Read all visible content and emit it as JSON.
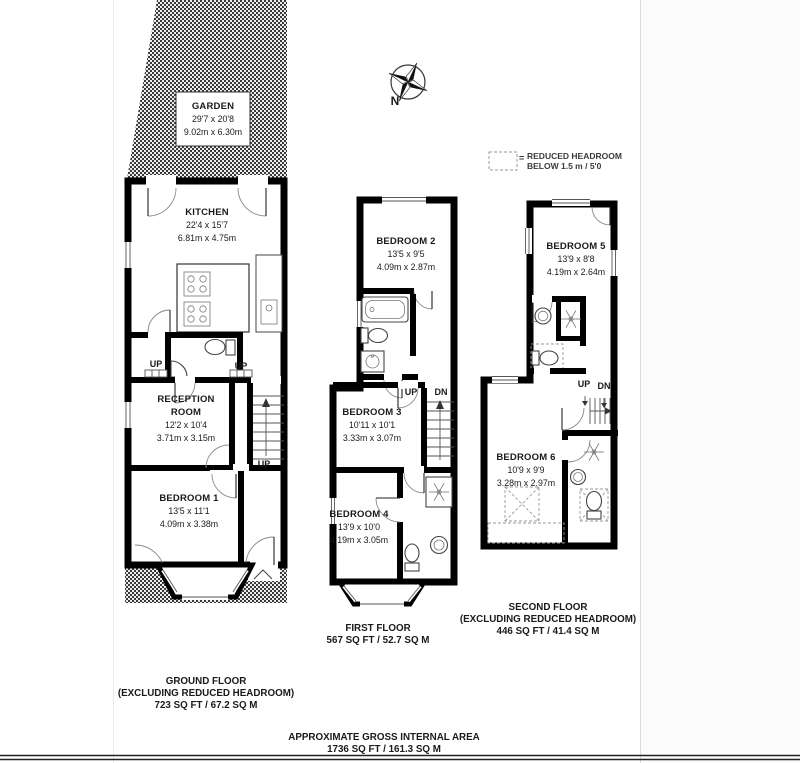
{
  "page": {
    "footer_line1": "APPROXIMATE GROSS INTERNAL AREA",
    "footer_line2": "1736 SQ FT / 161.3 SQ M"
  },
  "compass": {
    "north_label": "N"
  },
  "legend": {
    "equals": "=",
    "line1": "REDUCED HEADROOM",
    "line2": "BELOW 1.5 m / 5'0"
  },
  "stairs": {
    "up": "UP",
    "down": "DN"
  },
  "garden": {
    "name": "GARDEN",
    "dim_imperial": "29'7 x 20'8",
    "dim_metric": "9.02m x 6.30m"
  },
  "ground_floor": {
    "title_line1": "GROUND FLOOR",
    "title_line2": "(EXCLUDING REDUCED HEADROOM)",
    "title_line3": "723 SQ FT / 67.2 SQ M",
    "kitchen": {
      "name": "KITCHEN",
      "dim_imperial": "22'4 x 15'7",
      "dim_metric": "6.81m x 4.75m"
    },
    "reception": {
      "name": "RECEPTION ROOM",
      "dim_imperial": "12'2 x 10'4",
      "dim_metric": "3.71m x 3.15m"
    },
    "bedroom1": {
      "name": "BEDROOM 1",
      "dim_imperial": "13'5 x 11'1",
      "dim_metric": "4.09m x 3.38m"
    }
  },
  "first_floor": {
    "title_line1": "FIRST FLOOR",
    "title_line2": "567 SQ FT / 52.7 SQ M",
    "bedroom2": {
      "name": "BEDROOM 2",
      "dim_imperial": "13'5 x 9'5",
      "dim_metric": "4.09m x 2.87m"
    },
    "bedroom3": {
      "name": "BEDROOM 3",
      "dim_imperial": "10'11 x 10'1",
      "dim_metric": "3.33m x 3.07m"
    },
    "bedroom4": {
      "name": "BEDROOM 4",
      "dim_imperial": "13'9 x 10'0",
      "dim_metric": "4.19m x 3.05m"
    }
  },
  "second_floor": {
    "title_line1": "SECOND FLOOR",
    "title_line2": "(EXCLUDING REDUCED HEADROOM)",
    "title_line3": "446 SQ FT / 41.4 SQ M",
    "bedroom5": {
      "name": "BEDROOM 5",
      "dim_imperial": "13'9 x 8'8",
      "dim_metric": "4.19m x 2.64m"
    },
    "bedroom6": {
      "name": "BEDROOM 6",
      "dim_imperial": "10'9 x 9'9",
      "dim_metric": "3.28m x 2.97m"
    }
  },
  "colors": {
    "ink": "#1a1a1a",
    "hatch": "#3a3a3a"
  }
}
